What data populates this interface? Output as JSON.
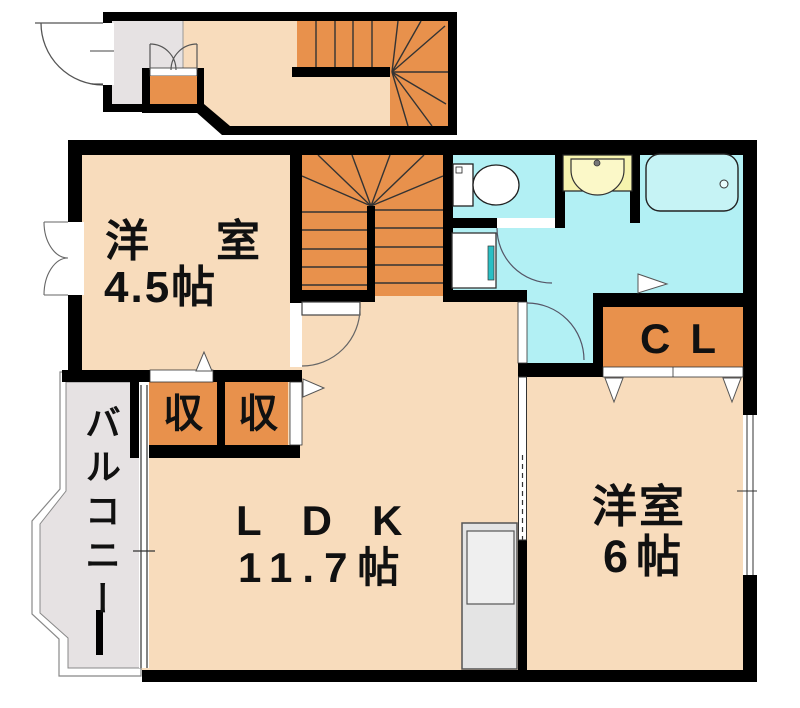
{
  "floorplan": {
    "rooms": {
      "western_small": {
        "name": "洋室",
        "size": "4.5帖"
      },
      "ldk": {
        "name": "LDK",
        "size": "11.7帖"
      },
      "western_large": {
        "name": "洋室",
        "size": "6帖"
      },
      "closet": {
        "label": "CL"
      },
      "storage_left": {
        "label": "収"
      },
      "storage_right": {
        "label": "収"
      },
      "balcony": {
        "label": "バルコニー"
      }
    },
    "colors": {
      "wall": "#000000",
      "floor": "#f8dcbc",
      "stairs_storage": "#e8914c",
      "wet_area": "#b2f0f4",
      "bathtub": "#c6f3f5",
      "vanity": "#f6f3ae",
      "entry_balcony": "#e6e2e3",
      "washer_accent": "#2bbfc4",
      "counter": "#e4e4e4"
    }
  }
}
